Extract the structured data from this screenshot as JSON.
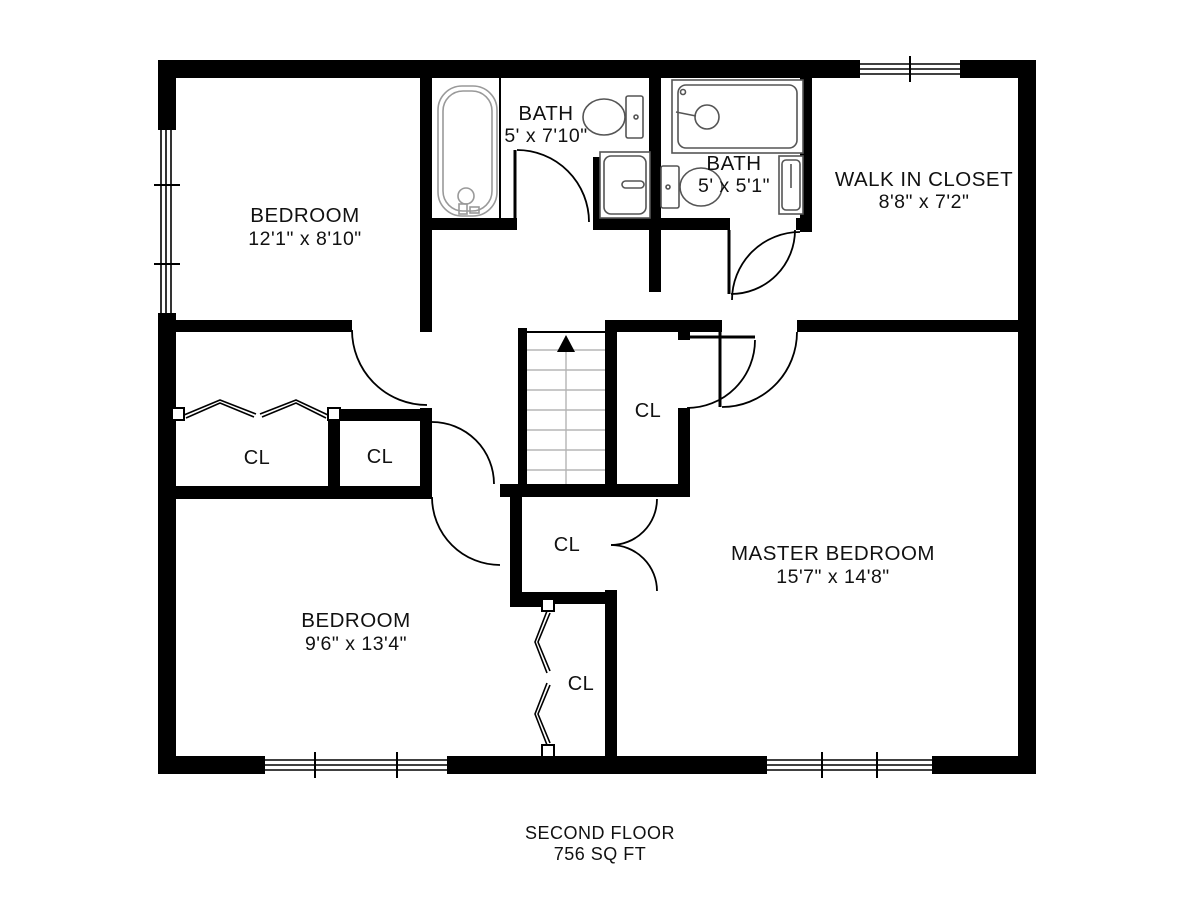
{
  "plan": {
    "title": "SECOND FLOOR",
    "area": "756 SQ FT",
    "rooms": [
      {
        "name": "BEDROOM",
        "dims": "12'1\" x 8'10\""
      },
      {
        "name": "BATH",
        "dims": "5' x 7'10\""
      },
      {
        "name": "BATH",
        "dims": "5' x 5'1\""
      },
      {
        "name": "WALK IN CLOSET",
        "dims": "8'8\" x 7'2\""
      },
      {
        "name": "MASTER BEDROOM",
        "dims": "15'7\" x 14'8\""
      },
      {
        "name": "BEDROOM",
        "dims": "9'6\" x 13'4\""
      }
    ],
    "closets": [
      {
        "label": "CL"
      },
      {
        "label": "CL"
      },
      {
        "label": "CL"
      },
      {
        "label": "CL"
      },
      {
        "label": "CL"
      }
    ],
    "colors": {
      "wall": "#000000",
      "fixture": "#555555",
      "tread": "#b5b5b5",
      "text": "#111111"
    }
  }
}
